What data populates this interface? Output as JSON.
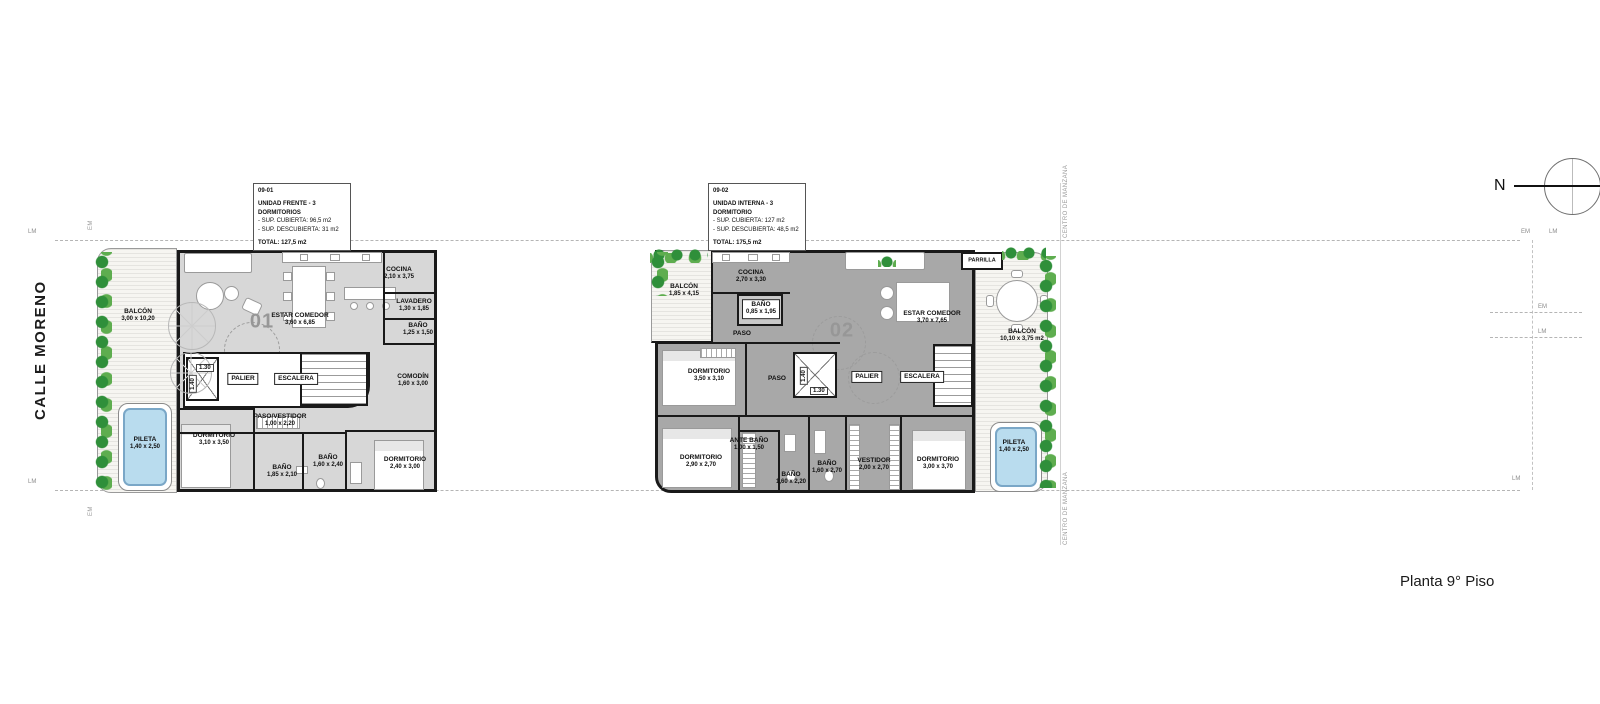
{
  "page": {
    "street": "CALLE MORENO",
    "plan_title": "Planta 9° Piso",
    "north": "N",
    "center_block": "CENTRO DE MANZANA",
    "marks": {
      "lm": "LM",
      "em": "EM"
    }
  },
  "colors": {
    "unit1_fill": "#d7d7d7",
    "unit2_fill": "#a8a8a8",
    "pool_fill": "#b9dcee",
    "plant_green": "#2f8f3a",
    "wall_black": "#191919"
  },
  "info_boxes": [
    {
      "code": "09-01",
      "title": "UNIDAD FRENTE - 3 DORMITORIOS",
      "sup1": "- SUP. CUBIERTA: 96,5 m2",
      "sup2": "- SUP. DESCUBIERTA: 31 m2",
      "total": "TOTAL: 127,5 m2"
    },
    {
      "code": "09-02",
      "title": "UNIDAD INTERNA - 3 DORMITORIO",
      "sup1": "- SUP. CUBIERTA: 127 m2",
      "sup2": "- SUP. DESCUBIERTA: 48,5 m2",
      "total": "TOTAL: 175,5 m2"
    }
  ],
  "units": {
    "u1": {
      "number": "01",
      "balcon": {
        "name": "BALCÓN",
        "dims": "3,00 x 10,20"
      },
      "pileta": {
        "name": "PILETA",
        "dims": "1,40 x 2,50"
      },
      "estar": {
        "name": "ESTAR COMEDOR",
        "dims": "3,60 x 6,85"
      },
      "cocina": {
        "name": "COCINA",
        "dims": "2,10 x 3,75"
      },
      "lavadero": {
        "name": "LAVADERO",
        "dims": "1,30 x 1,85"
      },
      "banio_sup": {
        "name": "BAÑO",
        "dims": "1,25 x 1,50"
      },
      "comodin": {
        "name": "COMODÍN",
        "dims": "1,60 x 3,00"
      },
      "palier": "PALIER",
      "escalera": "ESCALERA",
      "lift_w": "1.30",
      "lift_h": "1.40",
      "paso": {
        "name": "PASO/VESTIDOR",
        "dims": "1,00 x 2,20"
      },
      "dorm1": {
        "name": "DORMITORIO",
        "dims": "3,10 x 3,50"
      },
      "banio1": {
        "name": "BAÑO",
        "dims": "1,85 x 2,10"
      },
      "banio2": {
        "name": "BAÑO",
        "dims": "1,60 x 2,40"
      },
      "dorm2": {
        "name": "DORMITORIO",
        "dims": "2,40 x 3,00"
      }
    },
    "u2": {
      "number": "02",
      "balcon1": {
        "name": "BALCÓN",
        "dims": "1,85 x 4,15"
      },
      "cocina": {
        "name": "COCINA",
        "dims": "2,70 x 3,30"
      },
      "banio_sup": {
        "name": "BAÑO",
        "dims": "0,85 x 1,95"
      },
      "paso1": "PASO",
      "estar": {
        "name": "ESTAR COMEDOR",
        "dims": "3,70 x 7,65"
      },
      "parrilla": "PARRILLA",
      "balcon2": {
        "name": "BALCÓN",
        "dims": "10,10 x 3,75 m2"
      },
      "dorm1": {
        "name": "DORMITORIO",
        "dims": "3,50 x 3,10"
      },
      "paso2": "PASO",
      "palier": "PALIER",
      "escalera": "ESCALERA",
      "lift_w": "1.30",
      "lift_h": "1.40",
      "dorm2": {
        "name": "DORMITORIO",
        "dims": "2,90 x 2,70"
      },
      "antebanio": {
        "name": "ANTE BAÑO",
        "dims": "1,00 x 1,50"
      },
      "banio1": {
        "name": "BAÑO",
        "dims": "1,60 x 2,20"
      },
      "banio2": {
        "name": "BAÑO",
        "dims": "1,60 x 2,70"
      },
      "vestidor": {
        "name": "VESTIDOR",
        "dims": "2,00 x 2,70"
      },
      "dorm3": {
        "name": "DORMITORIO",
        "dims": "3,00 x 3,70"
      },
      "pileta": {
        "name": "PILETA",
        "dims": "1,40 x 2,50"
      }
    }
  }
}
